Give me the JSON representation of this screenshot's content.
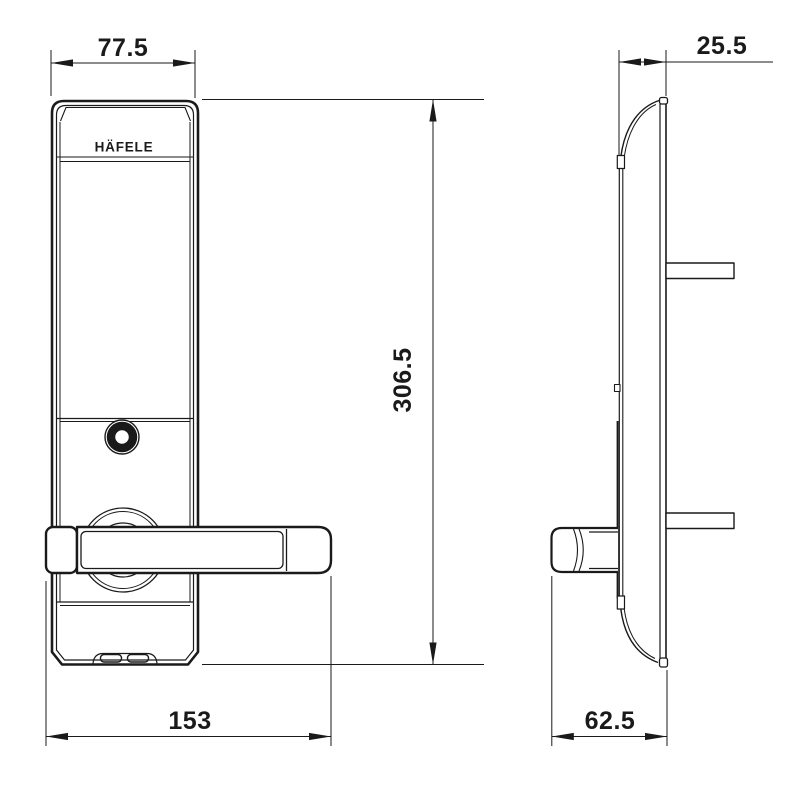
{
  "colors": {
    "ink": "#1a1a1a",
    "paper": "#ffffff"
  },
  "drawing": {
    "brand": "HÄFELE",
    "front_view": {
      "dim_top_width": "77.5",
      "dim_height": "306.5",
      "dim_bottom_width": "153"
    },
    "side_view": {
      "dim_top_depth": "25.5",
      "dim_bottom_depth": "62.5"
    }
  }
}
